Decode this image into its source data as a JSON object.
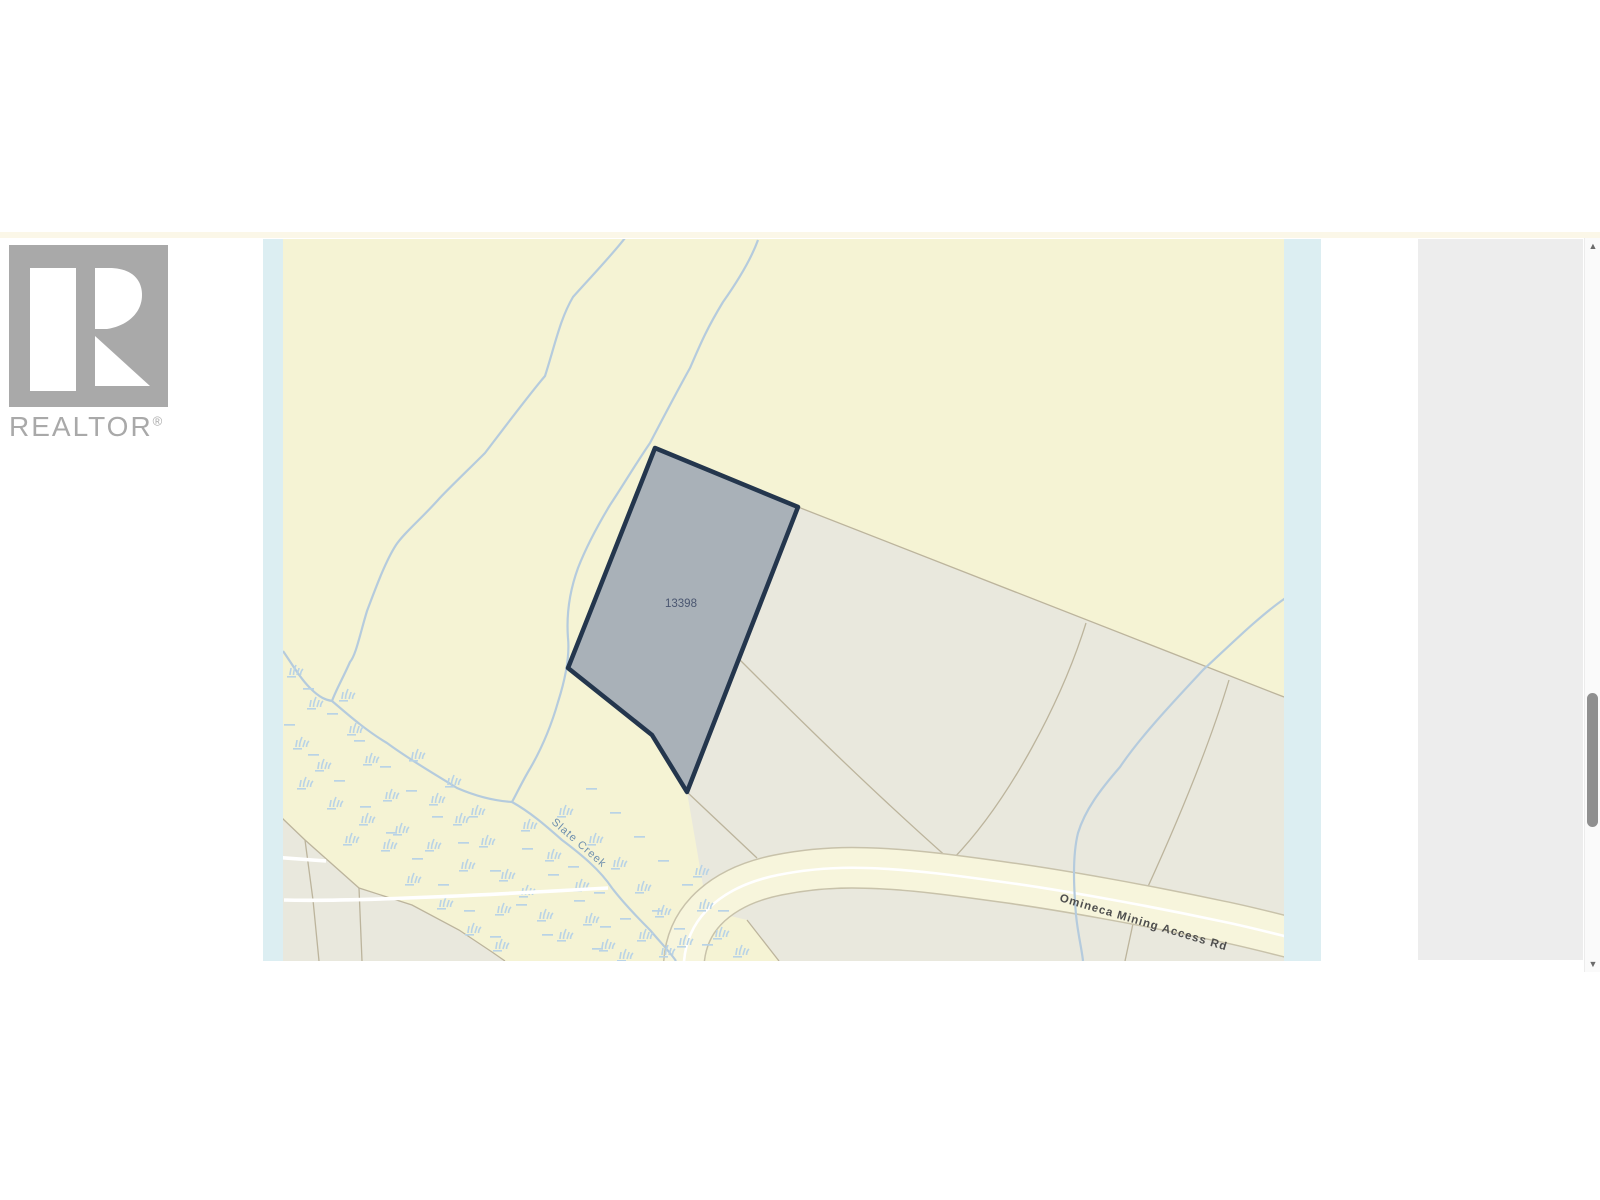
{
  "page": {
    "background": "#ffffff",
    "top_divider_color": "#fbf7e8"
  },
  "branding": {
    "logo_letter": "R",
    "logo_text": "REALTOR",
    "reg_mark": "®",
    "logo_gray": "#a9a9a9"
  },
  "map": {
    "labels": {
      "parcel": "13398",
      "creek": "Slate Creek",
      "road": "Omineca Mining Access Rd"
    },
    "colors": {
      "water_strip": "#dceef2",
      "land": "#f5f3d4",
      "parcel_area": "#e9e8dd",
      "boundary": "#bcb49c",
      "road_fill": "#f7f5dc",
      "road_casing": "#c8c2aa",
      "road_centerline": "#ffffff",
      "creek": "#b5cbdd",
      "marsh": "#b9d3e6",
      "trail": "#ffffff",
      "parcel_fill": "#a9b1b8",
      "parcel_border": "#24364d",
      "parcel_label_color": "#4a5670",
      "creek_label_color": "#6e8fae",
      "road_label_color": "#4e4e4e"
    },
    "marsh_tufts": [
      [
        290,
        668
      ],
      [
        310,
        700
      ],
      [
        296,
        740
      ],
      [
        318,
        762
      ],
      [
        350,
        726
      ],
      [
        342,
        692
      ],
      [
        366,
        756
      ],
      [
        386,
        792
      ],
      [
        362,
        816
      ],
      [
        396,
        826
      ],
      [
        412,
        752
      ],
      [
        432,
        796
      ],
      [
        428,
        842
      ],
      [
        456,
        816
      ],
      [
        462,
        862
      ],
      [
        482,
        838
      ],
      [
        502,
        872
      ],
      [
        498,
        906
      ],
      [
        522,
        888
      ],
      [
        540,
        912
      ],
      [
        560,
        932
      ],
      [
        586,
        916
      ],
      [
        602,
        942
      ],
      [
        620,
        952
      ],
      [
        524,
        822
      ],
      [
        548,
        852
      ],
      [
        576,
        882
      ],
      [
        640,
        932
      ],
      [
        662,
        948
      ],
      [
        680,
        938
      ],
      [
        700,
        902
      ],
      [
        716,
        930
      ],
      [
        736,
        948
      ],
      [
        696,
        868
      ],
      [
        560,
        808
      ],
      [
        590,
        836
      ],
      [
        614,
        860
      ],
      [
        638,
        884
      ],
      [
        658,
        908
      ],
      [
        448,
        778
      ],
      [
        472,
        808
      ],
      [
        384,
        842
      ],
      [
        408,
        876
      ],
      [
        440,
        900
      ],
      [
        468,
        926
      ],
      [
        496,
        942
      ],
      [
        330,
        800
      ],
      [
        346,
        836
      ],
      [
        300,
        780
      ]
    ],
    "marsh_dashes": [
      [
        303,
        688
      ],
      [
        327,
        713
      ],
      [
        354,
        740
      ],
      [
        380,
        766
      ],
      [
        406,
        790
      ],
      [
        432,
        816
      ],
      [
        458,
        842
      ],
      [
        308,
        754
      ],
      [
        334,
        780
      ],
      [
        360,
        806
      ],
      [
        284,
        724
      ],
      [
        386,
        832
      ],
      [
        412,
        858
      ],
      [
        438,
        884
      ],
      [
        464,
        910
      ],
      [
        490,
        936
      ],
      [
        516,
        904
      ],
      [
        490,
        870
      ],
      [
        542,
        934
      ],
      [
        592,
        948
      ],
      [
        568,
        866
      ],
      [
        594,
        892
      ],
      [
        620,
        918
      ],
      [
        522,
        848
      ],
      [
        548,
        874
      ],
      [
        574,
        900
      ],
      [
        600,
        926
      ],
      [
        652,
        910
      ],
      [
        674,
        928
      ],
      [
        702,
        944
      ],
      [
        718,
        910
      ],
      [
        682,
        884
      ],
      [
        658,
        860
      ],
      [
        634,
        836
      ],
      [
        610,
        812
      ],
      [
        586,
        788
      ]
    ]
  },
  "panel": {
    "background": "#ededed"
  },
  "scrollbar": {
    "up": "▲",
    "down": "▼"
  }
}
